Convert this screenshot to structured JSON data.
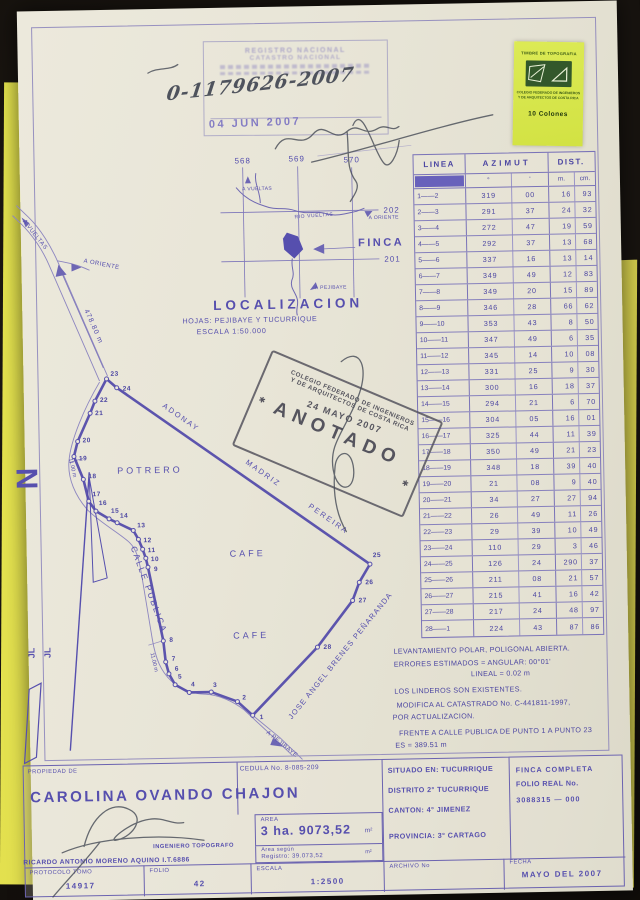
{
  "stamps": {
    "registry": {
      "line1": "REGISTRO NACIONAL",
      "line2": "CATASTRO NACIONAL",
      "number": "0-1179626-2007",
      "date": "04 JUN 2007"
    },
    "anotado": {
      "org_line1": "COLEGIO FEDERADO DE INGENIEROS",
      "org_line2": "Y DE ARQUITECTOS DE COSTA RICA",
      "date": "24 MAYO 2007",
      "word": "ANOTADO",
      "star": "✱"
    },
    "timbre": {
      "title": "TIMBRE DE TOPOGRAFIA",
      "org_line1": "COLEGIO FEDERADO DE INGENIEROS",
      "org_line2": "Y DE ARQUITECTOS DE COSTA RICA",
      "value": "10 Colones"
    }
  },
  "survey_table": {
    "headers": {
      "linea": "LINEA",
      "azimut": "AZIMUT",
      "dist": "DIST.",
      "deg": "°",
      "min": "'",
      "m": "m.",
      "cm": "cm."
    },
    "rows": [
      [
        "1——2",
        "319",
        "00",
        "16",
        "93"
      ],
      [
        "2——3",
        "291",
        "37",
        "24",
        "32"
      ],
      [
        "3——4",
        "272",
        "47",
        "19",
        "59"
      ],
      [
        "4——5",
        "292",
        "37",
        "13",
        "68"
      ],
      [
        "5——6",
        "337",
        "16",
        "13",
        "14"
      ],
      [
        "6——7",
        "349",
        "49",
        "12",
        "83"
      ],
      [
        "7——8",
        "349",
        "20",
        "15",
        "89"
      ],
      [
        "8——9",
        "346",
        "28",
        "66",
        "62"
      ],
      [
        "9——10",
        "353",
        "43",
        "8",
        "50"
      ],
      [
        "10——11",
        "347",
        "49",
        "6",
        "35"
      ],
      [
        "11——12",
        "345",
        "14",
        "10",
        "08"
      ],
      [
        "12——13",
        "331",
        "25",
        "9",
        "30"
      ],
      [
        "13——14",
        "300",
        "16",
        "18",
        "37"
      ],
      [
        "14——15",
        "294",
        "21",
        "6",
        "70"
      ],
      [
        "15——16",
        "304",
        "05",
        "16",
        "01"
      ],
      [
        "16——17",
        "325",
        "44",
        "11",
        "39"
      ],
      [
        "17——18",
        "350",
        "49",
        "21",
        "23"
      ],
      [
        "18——19",
        "348",
        "18",
        "39",
        "40"
      ],
      [
        "19——20",
        "21",
        "08",
        "9",
        "40"
      ],
      [
        "20——21",
        "34",
        "27",
        "27",
        "94"
      ],
      [
        "21——22",
        "26",
        "49",
        "11",
        "26"
      ],
      [
        "22——23",
        "29",
        "39",
        "10",
        "49"
      ],
      [
        "23——24",
        "110",
        "29",
        "3",
        "46"
      ],
      [
        "24——25",
        "126",
        "24",
        "290",
        "37"
      ],
      [
        "25——26",
        "211",
        "08",
        "21",
        "57"
      ],
      [
        "26——27",
        "215",
        "41",
        "16",
        "42"
      ],
      [
        "27——28",
        "217",
        "24",
        "48",
        "97"
      ],
      [
        "28——1",
        "224",
        "43",
        "87",
        "86"
      ]
    ]
  },
  "notes": {
    "lines": [
      {
        "t": "LEVANTAMIENTO POLAR, POLIGONAL ABIERTA.",
        "x": 3,
        "y": 6
      },
      {
        "t": "ERRORES ESTIMADOS = ANGULAR: 00°01'",
        "x": 3,
        "y": 19
      },
      {
        "t": "LINEAL = 0.02 m",
        "x": 80,
        "y": 30
      },
      {
        "t": "LOS LINDEROS SON EXISTENTES.",
        "x": 3,
        "y": 46
      },
      {
        "t": "MODIFICA AL CATASTRADO No. C-441811-1997,",
        "x": 5,
        "y": 60
      },
      {
        "t": "POR ACTUALIZACION.",
        "x": 1,
        "y": 72
      },
      {
        "t": "FRENTE A CALLE PUBLICA DE PUNTO 1 A PUNTO 23",
        "x": 7,
        "y": 88
      },
      {
        "t": "ES = 389.51 m",
        "x": 3,
        "y": 100
      }
    ]
  },
  "map": {
    "vertices": [
      {
        "n": "1",
        "x": 223,
        "y": 708,
        "lx": 230,
        "ly": 712
      },
      {
        "n": "2",
        "x": 208,
        "y": 694,
        "lx": 213,
        "ly": 692
      },
      {
        "n": "3",
        "x": 182,
        "y": 684,
        "lx": 184,
        "ly": 679
      },
      {
        "n": "4",
        "x": 160,
        "y": 684,
        "lx": 162,
        "ly": 678
      },
      {
        "n": "5",
        "x": 146,
        "y": 676,
        "lx": 149,
        "ly": 670
      },
      {
        "n": "6",
        "x": 140,
        "y": 665,
        "lx": 146,
        "ly": 662
      },
      {
        "n": "7",
        "x": 137,
        "y": 653,
        "lx": 143,
        "ly": 652
      },
      {
        "n": "8",
        "x": 135,
        "y": 632,
        "lx": 141,
        "ly": 633
      },
      {
        "n": "9",
        "x": 121,
        "y": 558,
        "lx": 127,
        "ly": 562
      },
      {
        "n": "10",
        "x": 119,
        "y": 549,
        "lx": 124,
        "ly": 552
      },
      {
        "n": "11",
        "x": 116,
        "y": 540,
        "lx": 121,
        "ly": 543
      },
      {
        "n": "12",
        "x": 112,
        "y": 530,
        "lx": 117,
        "ly": 533
      },
      {
        "n": "13",
        "x": 107,
        "y": 521,
        "lx": 111,
        "ly": 518
      },
      {
        "n": "14",
        "x": 91,
        "y": 513,
        "lx": 94,
        "ly": 508
      },
      {
        "n": "15",
        "x": 83,
        "y": 509,
        "lx": 85,
        "ly": 503
      },
      {
        "n": "16",
        "x": 70,
        "y": 501,
        "lx": 73,
        "ly": 495
      },
      {
        "n": "17",
        "x": 63,
        "y": 491,
        "lx": 67,
        "ly": 486
      },
      {
        "n": "18",
        "x": 58,
        "y": 469,
        "lx": 63,
        "ly": 468
      },
      {
        "n": "19",
        "x": 49,
        "y": 446,
        "lx": 54,
        "ly": 450
      },
      {
        "n": "20",
        "x": 53,
        "y": 431,
        "lx": 58,
        "ly": 432
      },
      {
        "n": "21",
        "x": 66,
        "y": 403,
        "lx": 71,
        "ly": 405
      },
      {
        "n": "22",
        "x": 71,
        "y": 391,
        "lx": 76,
        "ly": 392
      },
      {
        "n": "23",
        "x": 83,
        "y": 369,
        "lx": 87,
        "ly": 366
      },
      {
        "n": "24",
        "x": 93,
        "y": 378,
        "lx": 99,
        "ly": 381
      },
      {
        "n": "25",
        "x": 343,
        "y": 559,
        "lx": 346,
        "ly": 552
      },
      {
        "n": "26",
        "x": 332,
        "y": 577,
        "lx": 338,
        "ly": 579
      },
      {
        "n": "27",
        "x": 325,
        "y": 595,
        "lx": 331,
        "ly": 597
      },
      {
        "n": "28",
        "x": 289,
        "y": 641,
        "lx": 295,
        "ly": 643
      }
    ],
    "labels": [
      {
        "t": "568",
        "x": 215,
        "y": 156,
        "fs": 8,
        "ls": 1,
        "n": "grid-label-568"
      },
      {
        "t": "569",
        "x": 269,
        "y": 155,
        "fs": 8,
        "ls": 1,
        "n": "grid-label-569"
      },
      {
        "t": "570",
        "x": 324,
        "y": 157,
        "fs": 8,
        "ls": 1,
        "n": "grid-label-570"
      },
      {
        "t": "202",
        "x": 363,
        "y": 208,
        "fs": 8,
        "ls": 1,
        "n": "grid-label-202"
      },
      {
        "t": "201",
        "x": 363,
        "y": 257,
        "fs": 8,
        "ls": 1,
        "n": "grid-label-201"
      },
      {
        "t": "A VUELTAS",
        "x": 222,
        "y": 183,
        "fs": 5,
        "ls": 0.4,
        "n": "loc-a-vueltas"
      },
      {
        "t": "RIO VUELTAS",
        "x": 274,
        "y": 212,
        "r": -3,
        "fs": 5,
        "ls": 0.6,
        "n": "loc-rio-vueltas"
      },
      {
        "t": "A ORIENTE",
        "x": 348,
        "y": 214,
        "fs": 5,
        "ls": 0.4,
        "n": "loc-a-oriente"
      },
      {
        "t": "FINCA",
        "x": 337,
        "y": 241,
        "fs": 11,
        "ls": 2.5,
        "b": 1,
        "n": "loc-finca"
      },
      {
        "t": "A PEJIBAYE",
        "x": 293,
        "y": 283,
        "fs": 5,
        "ls": 0.4,
        "n": "loc-a-pejibaye"
      },
      {
        "t": "LOCALIZACION",
        "x": 191,
        "y": 302,
        "fs": 13.5,
        "ls": 4,
        "b": 1,
        "n": "loc-title"
      },
      {
        "t": "HOJAS: PEJIBAYE Y TUCURRIQUE",
        "x": 160,
        "y": 315,
        "fs": 7.2,
        "ls": 0.6,
        "n": "loc-sheets"
      },
      {
        "t": "ESCALA 1:50.000",
        "x": 174,
        "y": 326,
        "fs": 7.2,
        "ls": 0.8,
        "n": "loc-scale"
      },
      {
        "t": "478.80 m",
        "x": 62,
        "y": 300,
        "r": 67,
        "fs": 7,
        "ls": 1,
        "n": "road-distance"
      },
      {
        "t": "A ORIENTE",
        "x": 62,
        "y": 252,
        "r": 12,
        "fs": 6,
        "ls": 0.5,
        "n": "map-a-oriente"
      },
      {
        "t": "A VUELTAS",
        "x": 2,
        "y": 210,
        "r": 53,
        "fs": 6,
        "ls": 0.5,
        "n": "map-a-vueltas"
      },
      {
        "t": "ADONAY",
        "x": 138,
        "y": 398,
        "r": 36,
        "fs": 7.5,
        "ls": 2,
        "n": "neighbor-adonay"
      },
      {
        "t": "MADRIZ",
        "x": 220,
        "y": 456,
        "r": 36,
        "fs": 7.5,
        "ls": 2,
        "n": "neighbor-madriz"
      },
      {
        "t": "PEREIRA",
        "x": 282,
        "y": 501,
        "r": 36,
        "fs": 7.5,
        "ls": 2,
        "n": "neighbor-pereira"
      },
      {
        "t": "POTRERO",
        "x": 92,
        "y": 464,
        "fs": 9,
        "ls": 3,
        "n": "landuse-potrero"
      },
      {
        "t": "CAFE",
        "x": 203,
        "y": 549,
        "fs": 9,
        "ls": 3,
        "n": "landuse-cafe-1"
      },
      {
        "t": "CAFE",
        "x": 205,
        "y": 631,
        "fs": 9,
        "ls": 3,
        "n": "landuse-cafe-2"
      },
      {
        "t": "CALLE PUBLICA",
        "x": 104,
        "y": 538,
        "r": 71,
        "fs": 8.5,
        "ls": 2,
        "n": "road-calle-publica"
      },
      {
        "t": "JOSE ANGEL BRENES PEÑARANDA",
        "x": 262,
        "y": 713,
        "r": -50,
        "fs": 7.5,
        "ls": 1.2,
        "n": "neighbor-brenes"
      },
      {
        "t": "A PEJIBAYE",
        "x": 236,
        "y": 726,
        "r": 40,
        "fs": 6,
        "ls": 0.5,
        "n": "map-a-pejibaye"
      },
      {
        "t": "11.00 m",
        "x": 44,
        "y": 448,
        "r": 78,
        "fs": 5.5,
        "n": "road-width-1"
      },
      {
        "t": "11.00 m",
        "x": 122,
        "y": 644,
        "r": 78,
        "fs": 5.5,
        "n": "road-width-2"
      },
      {
        "t": "N",
        "x": 12,
        "y": 478,
        "r": -90,
        "fs": 30,
        "b": 1,
        "c": "north",
        "n": "north-letter"
      },
      {
        "t": "JL",
        "x": 6,
        "y": 647,
        "r": -90,
        "fs": 9,
        "b": 1,
        "n": "jl-mark-1"
      },
      {
        "t": "JL",
        "x": 22,
        "y": 647,
        "r": -90,
        "fs": 9,
        "b": 1,
        "n": "jl-mark-2"
      }
    ]
  },
  "form": {
    "propiedad_label": "PROPIEDAD DE",
    "cedula": "CEDULA No. 8-085-209",
    "owner": "CAROLINA OVANDO CHAJON",
    "area_label": "AREA",
    "area_value": "3 ha. 9073,52",
    "m2": "m²",
    "area_registro_l1": "Area según",
    "area_registro_l2": "Registro: 39.073,52",
    "engineer_title": "INGENIERO TOPOGRAFO",
    "engineer_name": "RICARDO ANTONIO MORENO AQUINO I.T.6886",
    "situado": "SITUADO EN: TUCURRIQUE",
    "distrito": "DISTRITO 2° TUCURRIQUE",
    "canton": "CANTON: 4° JIMENEZ",
    "provincia": "PROVINCIA: 3° CARTAGO",
    "finca_l1": "FINCA COMPLETA",
    "finca_l2": "FOLIO REAL No.",
    "finca_l3": "3088315 — 000",
    "protocolo_label": "PROTOCOLO TOMO",
    "protocolo_value": "14917",
    "folio_label": "FOLIO",
    "folio_value": "42",
    "escala_label": "ESCALA",
    "escala_value": "1:2500",
    "archivo_label": "ARCHIVO No",
    "fecha_label": "FECHA",
    "fecha_value": "MAYO DEL 2007"
  },
  "colors": {
    "ink": "#564fae",
    "ink_dark": "#4c46a2",
    "stamp_gray": "#55545e",
    "folder_yellow": "#ddd84e",
    "sticker_green": "#d2e243",
    "paper": "#e8e5d7"
  }
}
